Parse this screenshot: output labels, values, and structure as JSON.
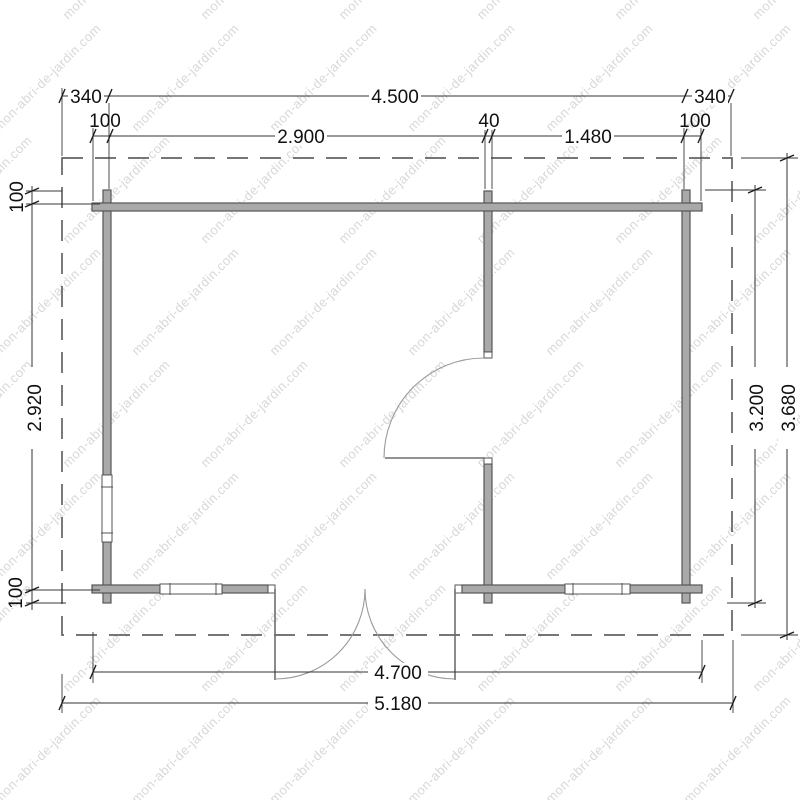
{
  "watermark": {
    "text": "mon-abri-de-jardin.com",
    "color": "#d8d8d8"
  },
  "plan": {
    "type": "floor-plan",
    "dims": {
      "top1": [
        "340",
        "4.500",
        "340"
      ],
      "top2": [
        "100",
        "2.900",
        "40",
        "1.480",
        "100"
      ],
      "left": [
        "100",
        "2.920",
        "100"
      ],
      "right": [
        "3.200",
        "3.680"
      ],
      "bottom": [
        "4.700",
        "5.180"
      ]
    },
    "colors": {
      "wall_fill": "#a9a9a9",
      "wall_stroke": "#565656",
      "dimension_line": "#333333",
      "roof_dash": "#636363",
      "watermark": "#d8d8d8"
    }
  }
}
